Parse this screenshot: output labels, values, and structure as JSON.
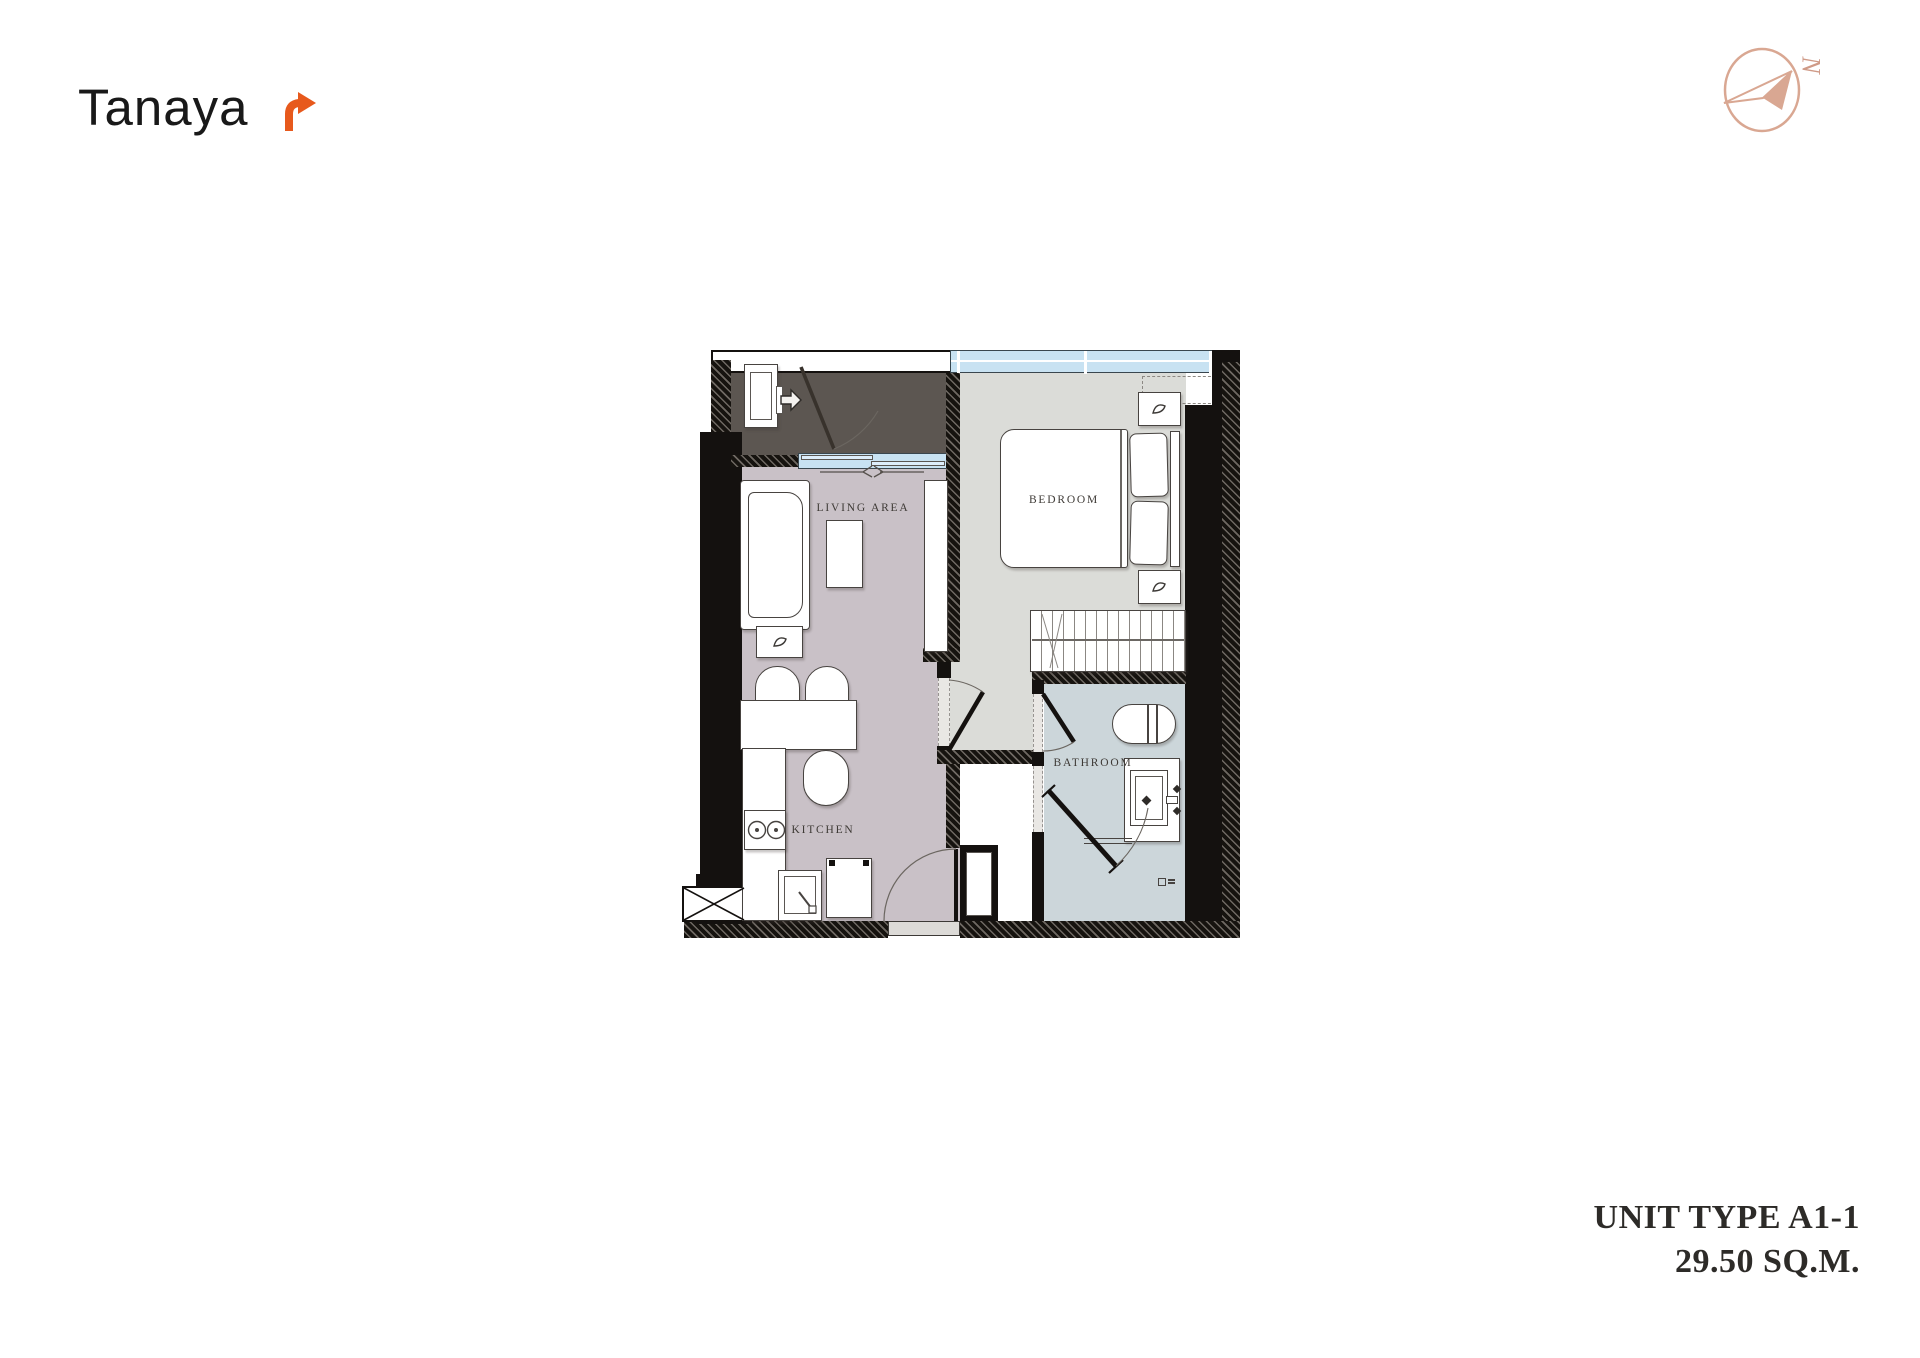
{
  "brand": {
    "wordmark": "Tanaya",
    "arrow_color": "#e7591c"
  },
  "compass": {
    "north_label": "N",
    "color": "#d9a792"
  },
  "unit_info": {
    "line1": "UNIT TYPE A1-1",
    "line2": "29.50 SQ.M."
  },
  "floorplan": {
    "rooms": [
      {
        "id": "living",
        "label": "LIVING AREA"
      },
      {
        "id": "bedroom",
        "label": "BEDROOM"
      },
      {
        "id": "kitchen",
        "label": "KITCHEN"
      },
      {
        "id": "bathroom",
        "label": "BATHROOM"
      }
    ],
    "colors": {
      "entry_floor": "#5c5651",
      "living_floor": "#c9c1c7",
      "bedroom_floor": "#dbdcd8",
      "bathroom_floor": "#ccd6da",
      "wall": "#14110f",
      "window": "#c8e2f2"
    }
  }
}
